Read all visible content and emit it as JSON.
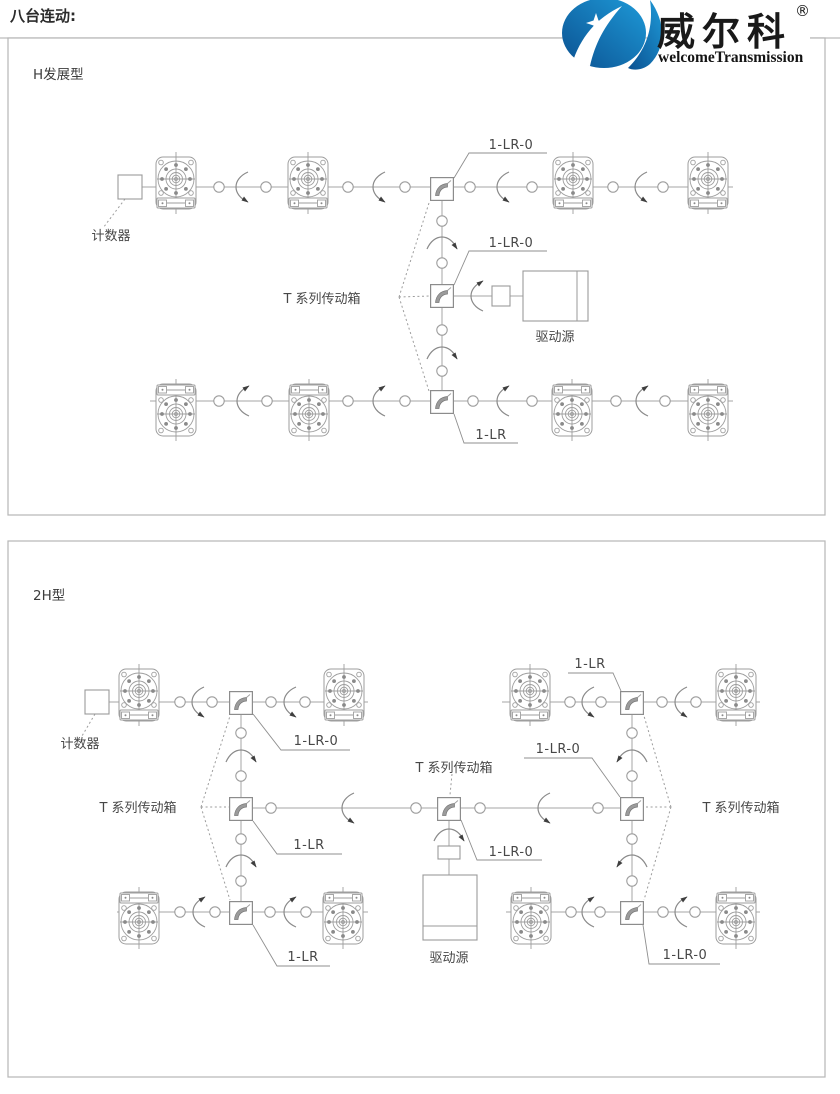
{
  "header": {
    "title": "八台连动:"
  },
  "logo": {
    "brand": "威尔科",
    "registered": "®",
    "subtitle": "welcomeTransmission",
    "blue_dark": "#0b5191",
    "blue_light": "#1e9ad8"
  },
  "panel1": {
    "type_label": "H发展型",
    "counter_label": "计数器",
    "t_series_label": "T 系列传动箱",
    "drive_label": "驱动源",
    "lr0_top": "1-LR-0",
    "lr0_mid": "1-LR-0",
    "lr_bottom": "1-LR"
  },
  "panel2": {
    "type_label": "2H型",
    "counter_label": "计数器",
    "t_series_left": "T 系列传动箱",
    "t_series_center": "T 系列传动箱",
    "t_series_right": "T 系列传动箱",
    "drive_label": "驱动源",
    "lr0_top_left": "1-LR-0",
    "lr_top_right": "1-LR",
    "lr_left_mid": "1-LR",
    "lr0_right_mid": "1-LR-0",
    "lr0_center": "1-LR-0",
    "lr_bottom_left": "1-LR",
    "lr0_bottom_right": "1-LR-0"
  }
}
